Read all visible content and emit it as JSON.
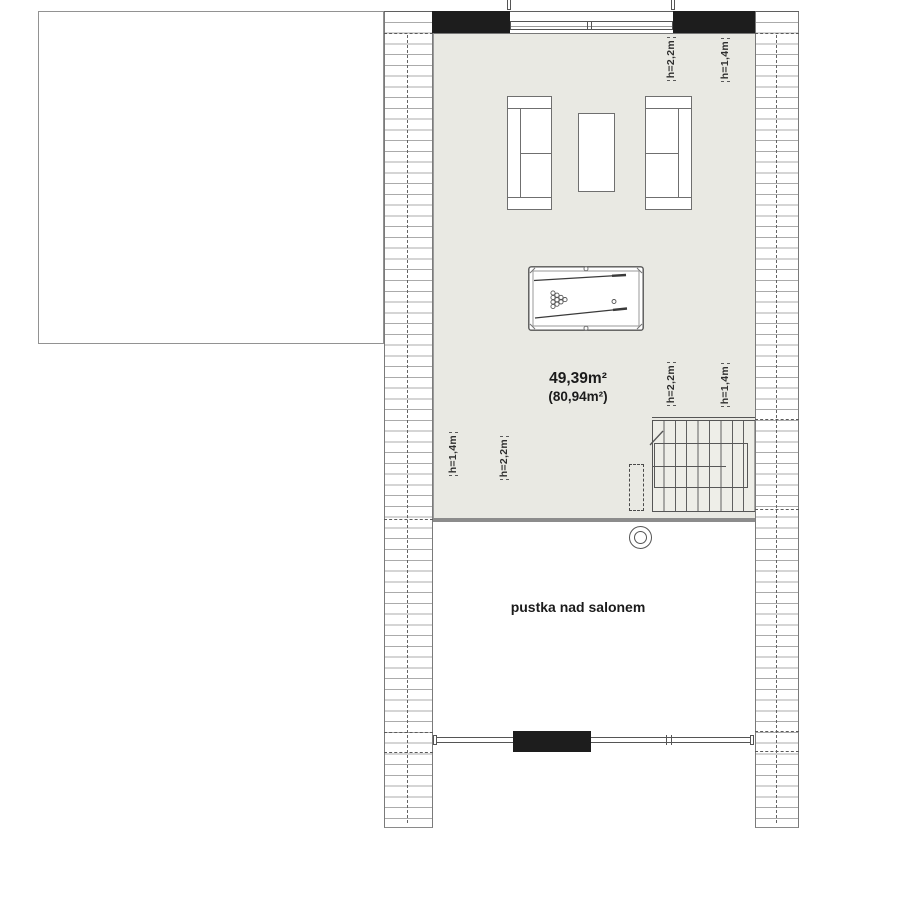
{
  "room": {
    "area_primary": "49,39m²",
    "area_secondary": "(80,94m²)"
  },
  "labels": {
    "void": "pustka nad salonem",
    "h_22": "h=2,2m",
    "h_14": "h=1,4m"
  },
  "colors": {
    "room_fill": "#e9e9e3",
    "wall_black": "#1d1d1d",
    "line_gray": "#5f5f5f",
    "hatch_gray": "#ababab",
    "floor_edge": "#8c8c8c",
    "background": "#ffffff"
  }
}
